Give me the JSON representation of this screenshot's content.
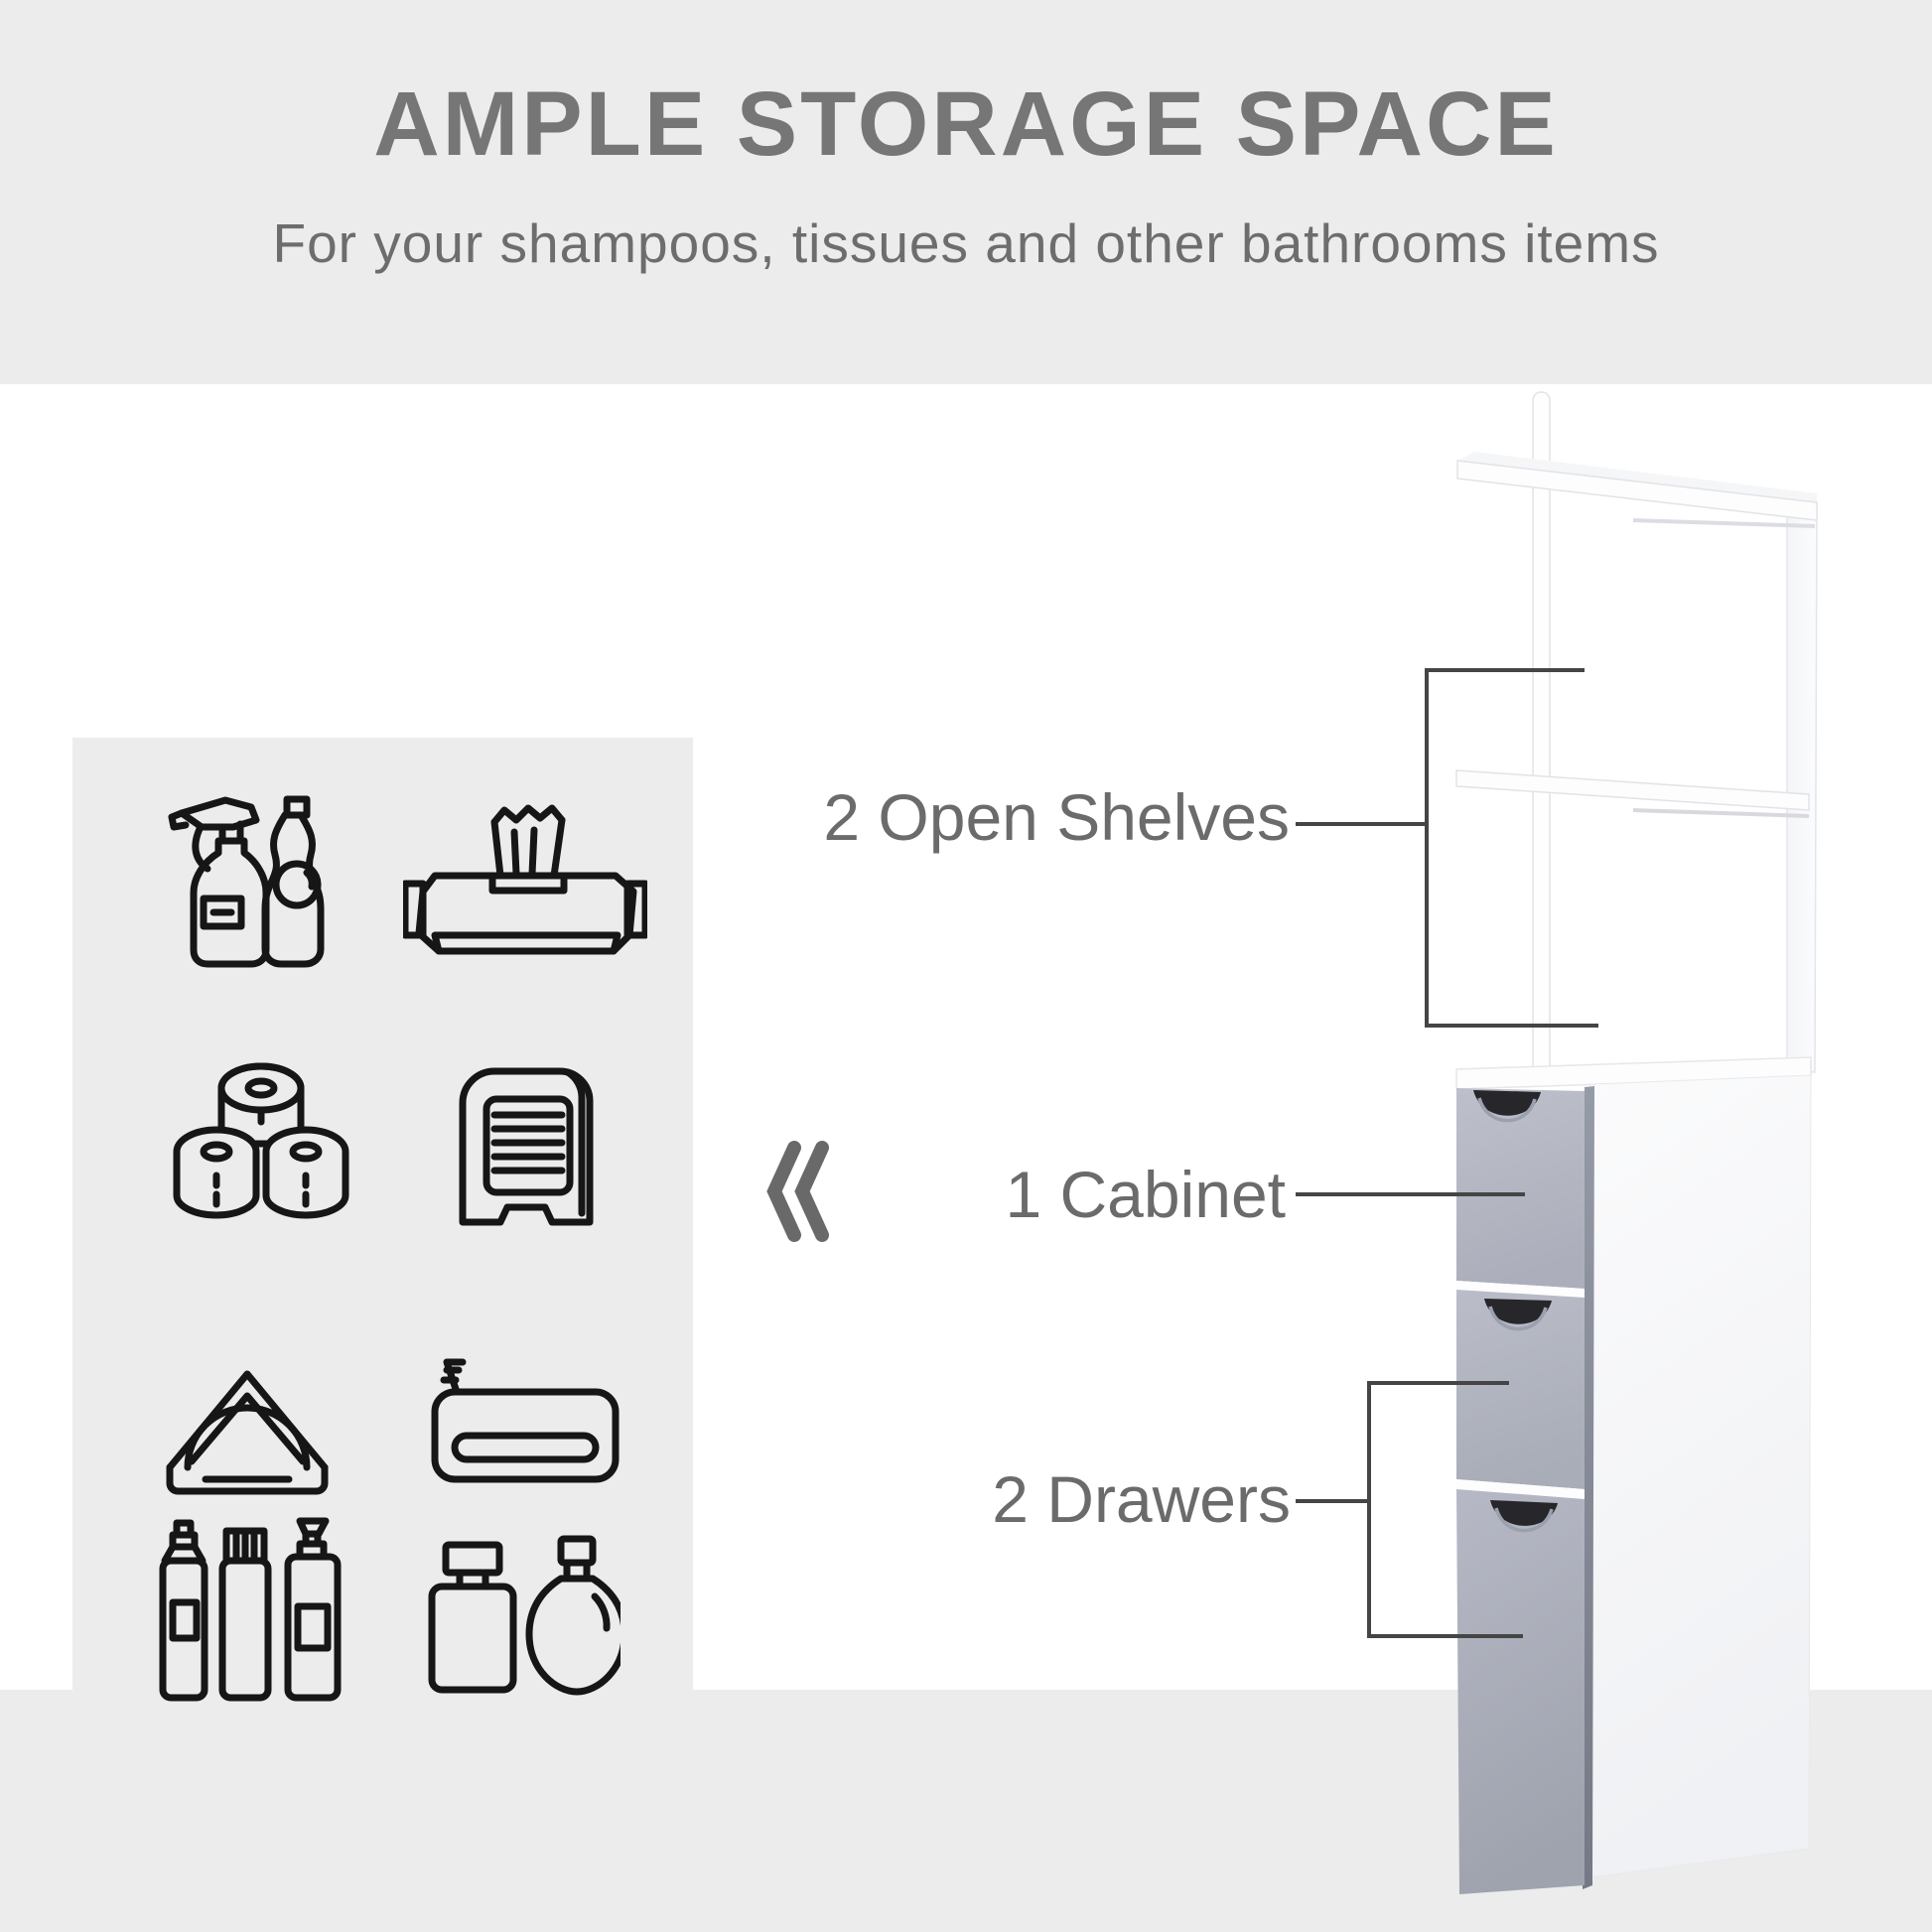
{
  "header": {
    "title": "AMPLE STORAGE SPACE",
    "subtitle": "For your shampoos, tissues and other bathrooms items"
  },
  "callouts": {
    "open_shelves": {
      "label": "2 Open Shelves",
      "points_to": "upper open shelf unit"
    },
    "cabinet": {
      "label": "1 Cabinet",
      "points_to": "top cabinet door"
    },
    "drawers": {
      "label": "2 Drawers",
      "points_to": "two lower drawers"
    }
  },
  "chevron_symbol": "«",
  "icon_panel": {
    "icons": [
      {
        "name": "cleaning-bottles-icon",
        "depicts": "spray bottle and soap bottle"
      },
      {
        "name": "wet-wipes-icon",
        "depicts": "pack of tissues / wet wipes"
      },
      {
        "name": "toilet-paper-rolls-icon",
        "depicts": "three toilet paper rolls"
      },
      {
        "name": "paper-towel-dispenser-icon",
        "depicts": "towel dispenser box"
      },
      {
        "name": "napkin-holder-icon",
        "depicts": "napkin holder"
      },
      {
        "name": "folded-towel-icon",
        "depicts": "folded bath towel"
      },
      {
        "name": "toiletry-bottles-icon",
        "depicts": "three spray / pump bottles"
      },
      {
        "name": "perfume-bottles-icon",
        "depicts": "two perfume bottles"
      }
    ]
  },
  "cabinet_figure": {
    "parts": [
      "top shelf",
      "middle shelf",
      "support pole",
      "cabinet door",
      "upper drawer",
      "lower drawer"
    ]
  },
  "colors": {
    "band_background": "#ececec",
    "title_text": "#767676",
    "subtitle_text": "#6d6d6d",
    "callout_text": "#6b6b6b",
    "callout_line": "#454545",
    "icon_stroke": "#161616",
    "cabinet_gray_front": "#b3b6c2",
    "cabinet_edge": "#8a8f9c",
    "handle_cutout": "#26262b"
  }
}
